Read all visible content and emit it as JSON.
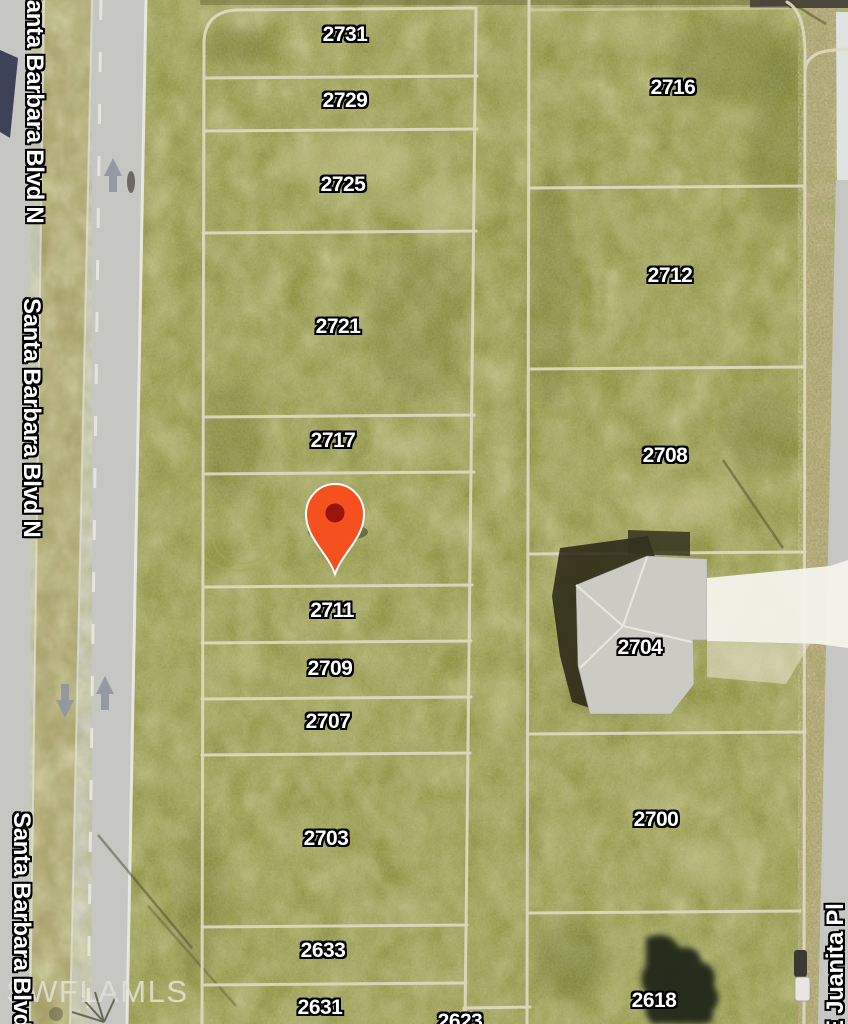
{
  "title": "Aerial parcel map with lot pin",
  "streets": {
    "left_1": "Santa Barbara Blvd N",
    "left_2": "Santa Barbara Blvd N",
    "left_3": "Santa Barbara Blvd N",
    "right_1": "E Juanita Pl"
  },
  "watermark": "SWFLAMLS",
  "parcels": {
    "center": [
      "2731",
      "2729",
      "2725",
      "2721",
      "2717",
      "2711",
      "2709",
      "2707",
      "2703",
      "2633",
      "2631",
      "2623"
    ],
    "right": [
      "2716",
      "2712",
      "2708",
      "2704",
      "2700",
      "2618"
    ]
  },
  "marker": {
    "type": "map-pin",
    "color": "#f4511e",
    "inner_color": "#99150d"
  },
  "road_markings": {
    "up_arrows": 2,
    "down_arrows": 1
  },
  "colors": {
    "grass_base": "#8d9140",
    "road_gray": "#c6c7c2",
    "median_tan": "#a89d6a",
    "shoulder_tan": "#ac9f70",
    "parcel_line": "#ded9c3",
    "pin_red": "#f4511e",
    "pin_inner": "#99150d",
    "label_text": "#ffffff",
    "label_outline": "#000000",
    "watermark_color": "#e2e2da",
    "arrow_gray": "#8f959e"
  }
}
